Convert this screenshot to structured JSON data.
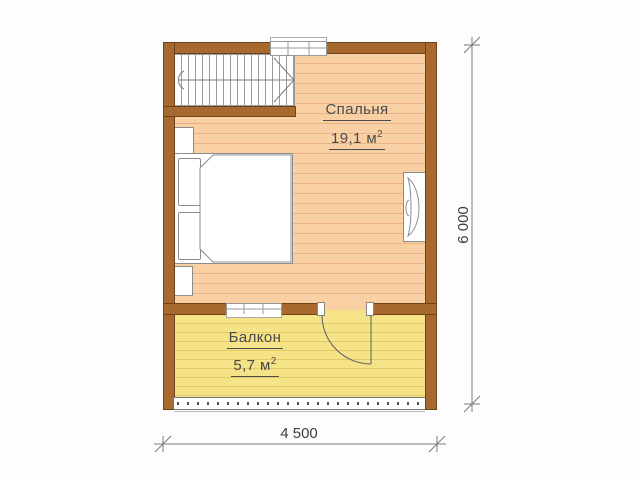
{
  "floor_plan": {
    "rooms": [
      {
        "label": "Спальня",
        "area_value": "19,1 м",
        "area_exponent": "2"
      },
      {
        "label": "Балкон",
        "area_value": "5,7 м",
        "area_exponent": "2"
      }
    ],
    "dimensions": {
      "horizontal": "4 500",
      "vertical": "6 000"
    },
    "colors": {
      "wall": "#a8692f",
      "wall_outline": "#6f4318",
      "bedroom_floor": "#f8d0a4",
      "bedroom_plank": "#eab285",
      "balcony_floor": "#f6e388",
      "balcony_plank": "#e0c967",
      "furniture_outline": "#8c8c8c",
      "label_text": "#4a4a4a",
      "dimension_text": "#3c3c3c"
    }
  }
}
